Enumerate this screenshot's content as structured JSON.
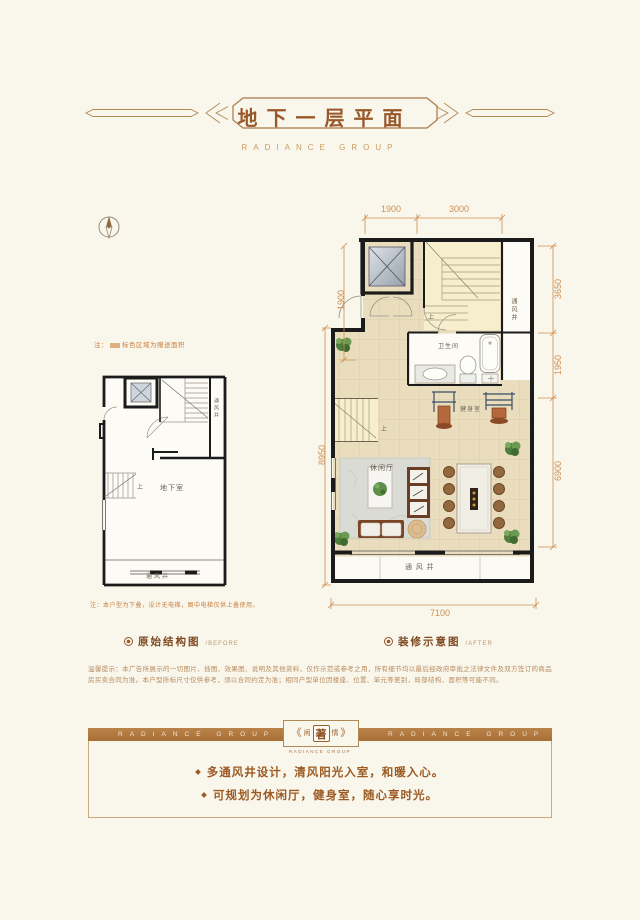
{
  "header": {
    "title": "地下一层平面",
    "subtitle": "RADIANCE GROUP"
  },
  "before": {
    "note_top_prefix": "注：",
    "note_top_text": "标色区域为赠送面积",
    "room_label": "地下室",
    "vent_right": "通风井",
    "vent_bottom": "通风井",
    "stairs_up": "上",
    "note_bottom": "注：本户型为下叠，设计无电梯，图中电梯仅供上叠使用。",
    "caption": "原始结构图",
    "caption_tag": "/BEFORE"
  },
  "after": {
    "dims": {
      "top1": "1900",
      "top2": "3000",
      "left_inner": "1900",
      "left_outer": "8950",
      "right1": "3650",
      "right2": "1950",
      "right3": "6900",
      "bottom": "7100"
    },
    "bathroom": "卫生间",
    "gym": "健身室",
    "lounge": "休闲厅",
    "vent_right": "通风井",
    "vent_bottom": "通 风 井",
    "stairs_up1": "上",
    "stairs_up2": "上",
    "caption": "装修示意图",
    "caption_tag": "/AFTER"
  },
  "disclaimer": "温馨提示：本广告所展示的一切图片、插图、效果图、说明及其他资料，仅作示范或参考之用，所有细节均以最后经政府审批之法律文件及双方签订的商品房买卖合同为准。本户型所标尺寸仅供参考，须以合同约定为准；相同户型单位因楼座、位置、单元等差别，局部结构、面积等可能不同。",
  "footer": {
    "band_left": "RADIANCE GROUP",
    "band_right": "RADIANCE GROUP",
    "emblem": {
      "outer_left": "《",
      "left": "闲",
      "center": "著",
      "right": "情",
      "outer_right": "》",
      "sub": "RADIANCE GROUP"
    },
    "bullets": [
      "多通风井设计，清风阳光入室，和暖入心。",
      "可规划为休闲厅，健身室，随心享时光。"
    ]
  },
  "colors": {
    "accent": "#b17a41",
    "dim": "#cf8f4f",
    "title": "#99582a",
    "wall": "#1b1b1b",
    "floor": "#e9ddbe"
  }
}
